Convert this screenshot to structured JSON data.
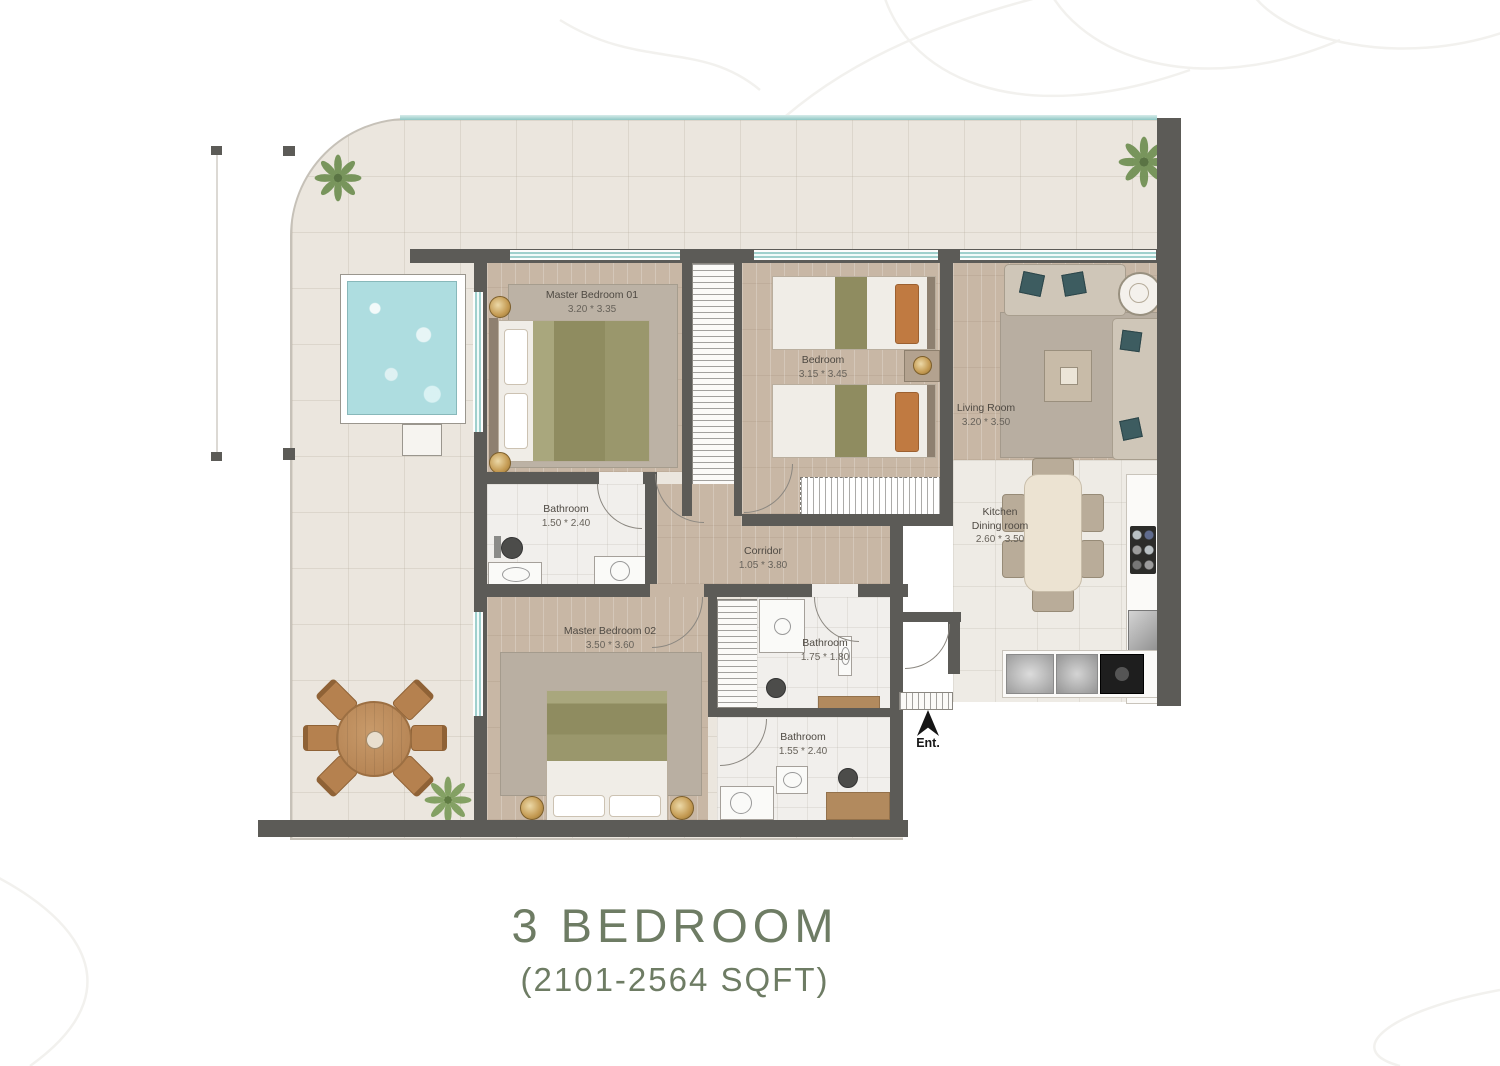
{
  "title": {
    "heading": "3 BEDROOM",
    "subheading": "(2101-2564 SQFT)"
  },
  "rooms": {
    "master_bedroom_01": {
      "label": "Master Bedroom 01",
      "dims": "3.20 * 3.35"
    },
    "bedroom": {
      "label": "Bedroom",
      "dims": "3.15 * 3.45"
    },
    "living_room": {
      "label": "Living Room",
      "dims": "3.20 * 3.50"
    },
    "kitchen": {
      "label_line1": "Kitchen",
      "label_line2": "Dining room",
      "dims": "2.60 * 3.50"
    },
    "corridor": {
      "label": "Corridor",
      "dims": "1.05 * 3.80"
    },
    "bathroom_1": {
      "label": "Bathroom",
      "dims": "1.50 * 2.40"
    },
    "master_bedroom_02": {
      "label": "Master Bedroom 02",
      "dims": "3.50 * 3.60"
    },
    "bathroom_2": {
      "label": "Bathroom",
      "dims": "1.75 * 1.80"
    },
    "bathroom_3": {
      "label": "Bathroom",
      "dims": "1.55 * 2.40"
    }
  },
  "entrance": {
    "label": "Ent."
  },
  "icons": {
    "entrance_arrow": "up-arrow",
    "plant": "shrub-top-view"
  },
  "colors": {
    "wall": "#5c5b57",
    "glass": "#8fc7c4",
    "pool": "#aedde0",
    "wood_floor": "#c8b7a5",
    "terrace": "#ebe6de",
    "title_text": "#6e7c64",
    "sofa_pillow": "#3d5c60",
    "outdoor_wood": "#b5814f"
  }
}
